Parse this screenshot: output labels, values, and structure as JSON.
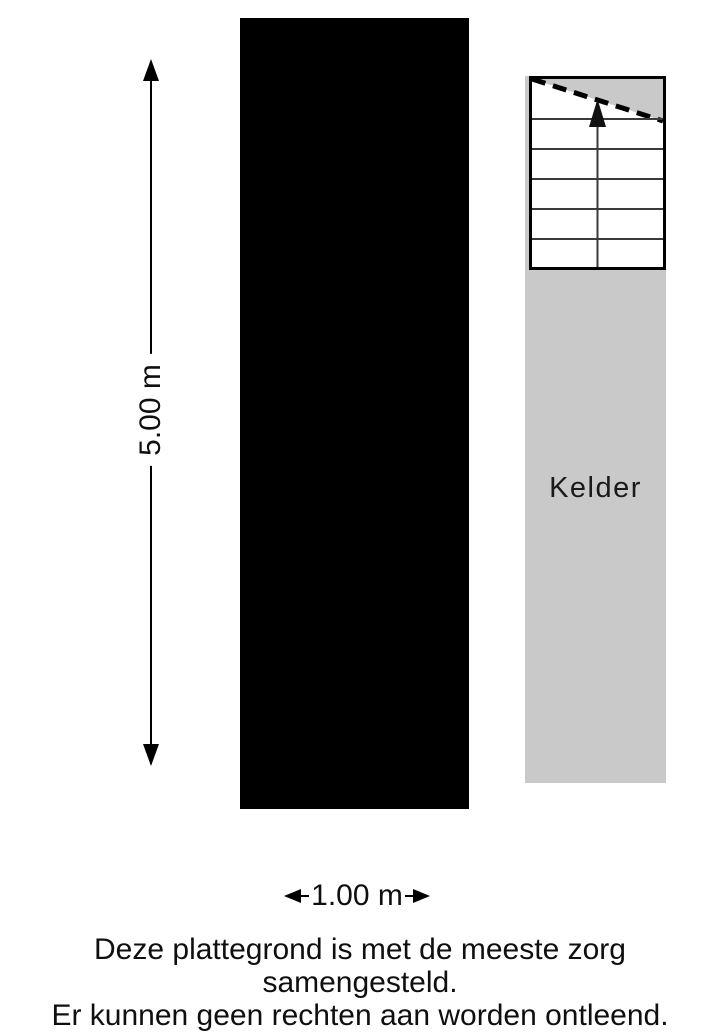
{
  "plan": {
    "room": {
      "label": "Kelder"
    },
    "dimensions": {
      "height_label": "5.00 m",
      "width_label": "1.00 m"
    },
    "stairs": {
      "direction": "up",
      "tread_count": 5,
      "icon": "up-arrow"
    },
    "colors": {
      "wall": "#000000",
      "floor": "#c9c9c9",
      "stair_floor": "#ffffff",
      "tread_line": "#3a3a3a"
    }
  },
  "footer": {
    "line1": "Deze plattegrond is met de meeste zorg samengesteld.",
    "line2": "Er kunnen geen rechten aan worden ontleend."
  }
}
